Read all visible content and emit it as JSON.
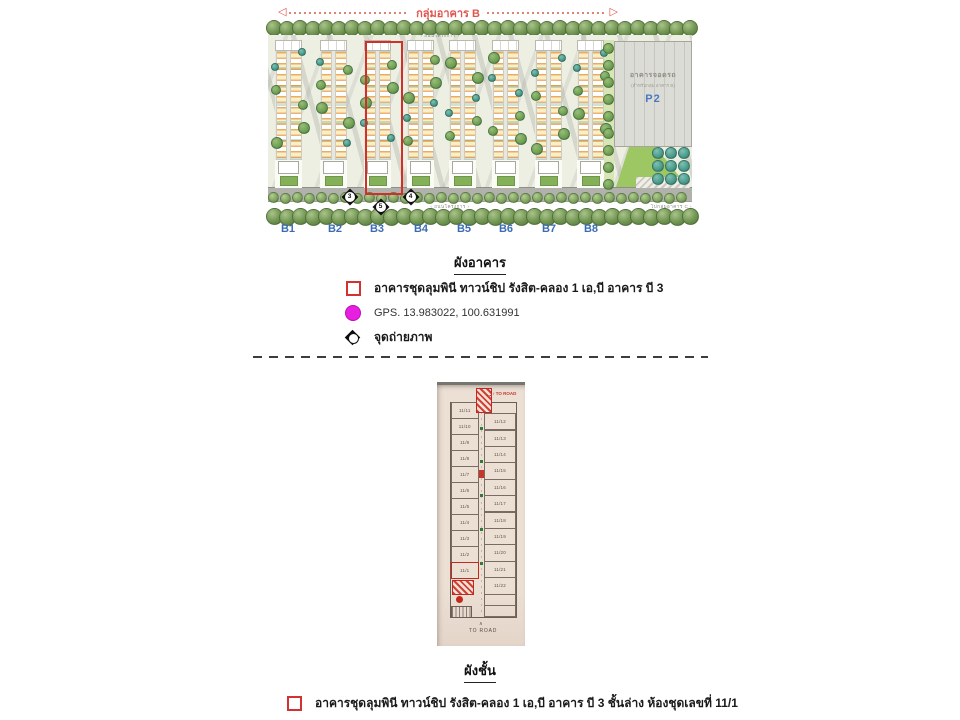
{
  "site_plan": {
    "group_arrow_label": "กลุ่มอาคาร B",
    "road_label_top": "‹ ถนนโครงการ ›",
    "road_label_bottom": "‹ ถนนโครงการ ›",
    "to_group_c_label": "ไปกลุ่มอาคาร C ›",
    "building_labels": [
      "B1",
      "B2",
      "B3",
      "B4",
      "B5",
      "B6",
      "B7",
      "B8"
    ],
    "highlighted_building": "B3",
    "parking_building": {
      "title": "อาคารจอดรถ",
      "subtitle": "(สำหรับกลุ่ม อาคาร B)",
      "code": "P2"
    },
    "camera_markers": [
      "3",
      "4",
      "5"
    ]
  },
  "building_plan_section": {
    "title": "ผังอาคาร",
    "legend": [
      {
        "icon": "red-outline-square",
        "label": "อาคารชุดลุมพินี ทาวน์ชิป รังสิต-คลอง 1 เอ,บี อาคาร บี 3"
      },
      {
        "icon": "magenta-circle",
        "label": "GPS. 13.983022, 100.631991"
      },
      {
        "icon": "photo-point-diamond",
        "label": "จุดถ่ายภาพ"
      }
    ]
  },
  "floor_plan": {
    "to_road_label_top": "› TO ROAD",
    "to_road_label_bottom": "TO ROAD",
    "left_units": [
      "11/11",
      "11/10",
      "11/9",
      "11/8",
      "11/7",
      "11/6",
      "11/5",
      "11/4",
      "11/3",
      "11/2",
      "11/1"
    ],
    "right_units": [
      "11/12",
      "11/13",
      "11/14",
      "11/15",
      "11/16",
      "11/17",
      "11/18",
      "11/19",
      "11/20",
      "11/21",
      "11/22"
    ],
    "highlighted_unit": "11/1"
  },
  "floor_plan_section": {
    "title": "ผังชั้น",
    "legend": [
      {
        "icon": "red-outline-square",
        "label": "อาคารชุดลุมพินี ทาวน์ชิป รังสิต-คลอง 1 เอ,บี อาคาร บี 3 ชั้นล่าง ห้องชุดเลขที่ 11/1"
      }
    ]
  },
  "colors": {
    "highlight_red": "#d03028",
    "gps_magenta": "#e81ee0",
    "building_label_blue": "#3a6cb4",
    "group_label_red": "#e0564e"
  }
}
